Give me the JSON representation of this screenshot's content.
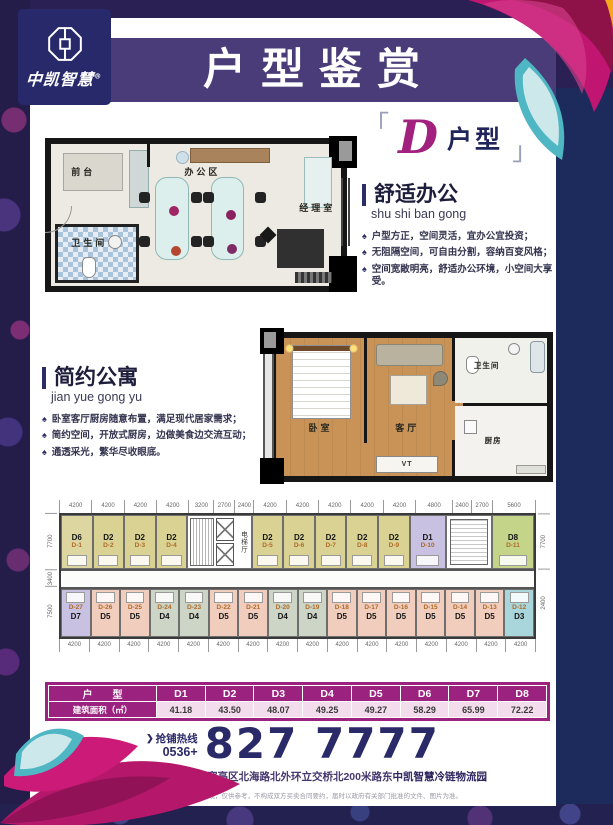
{
  "brand": {
    "logo_text": "中凯智慧",
    "logo_reg": "®",
    "emblem": "octagon-coin-emblem"
  },
  "header": {
    "banner_title": "户型鉴赏"
  },
  "unit_badge": {
    "open": "「",
    "letter": "D",
    "suffix": "户型",
    "close": "」"
  },
  "icons": {
    "bullet": "♠",
    "hotline_arrow": "❯"
  },
  "office_plan": {
    "rooms": {
      "reception": "前台",
      "work_area": "办公区",
      "manager": "经理室",
      "bathroom": "卫生间"
    }
  },
  "office_section": {
    "title": "舒适办公",
    "pinyin": "shu shi ban gong",
    "bullets": [
      "户型方正，空间灵活，宜办公宜投资；",
      "无阻隔空间，可自由分割，容纳百变风格；",
      "空间宽敞明亮，舒适办公环境，小空间大享受。"
    ]
  },
  "apartment_plan": {
    "rooms": {
      "bedroom": "卧室",
      "living": "客厅",
      "bathroom": "卫生间",
      "kitchen": "厨房"
    },
    "tv_label": "VT"
  },
  "apartment_section": {
    "title": "简约公寓",
    "pinyin": "jian yue gong yu",
    "bullets": [
      "卧室客厅厨房随意布置，满足现代居家需求；",
      "简约空间，开放式厨房，边做美食边交流互动；",
      "通透采光，繁华尽收眼底。"
    ]
  },
  "floorplate": {
    "elevator_hall": "电梯厅",
    "top_dims": [
      {
        "v": "4200",
        "f": "4200"
      },
      {
        "v": "4200",
        "f": "4200"
      },
      {
        "v": "4200",
        "f": "4200"
      },
      {
        "v": "4200",
        "f": "4200"
      },
      {
        "v": "3200",
        "f": "3200"
      },
      {
        "v": "2700",
        "f": "2700"
      },
      {
        "v": "2400",
        "f": "2400"
      },
      {
        "v": "4200",
        "f": "4200"
      },
      {
        "v": "4200",
        "f": "4200"
      },
      {
        "v": "4200",
        "f": "4200"
      },
      {
        "v": "4200",
        "f": "4200"
      },
      {
        "v": "4200",
        "f": "4200"
      },
      {
        "v": "4800",
        "f": "4800"
      },
      {
        "v": "2400",
        "f": "2400"
      },
      {
        "v": "2700",
        "f": "2700"
      },
      {
        "v": "5600",
        "f": "5600"
      }
    ],
    "bottom_dims": [
      {
        "v": "4200",
        "f": "1"
      },
      {
        "v": "4200",
        "f": "1"
      },
      {
        "v": "4200",
        "f": "1"
      },
      {
        "v": "4200",
        "f": "1"
      },
      {
        "v": "4200",
        "f": "1"
      },
      {
        "v": "4200",
        "f": "1"
      },
      {
        "v": "4200",
        "f": "1"
      },
      {
        "v": "4200",
        "f": "1"
      },
      {
        "v": "4200",
        "f": "1"
      },
      {
        "v": "4200",
        "f": "1"
      },
      {
        "v": "4200",
        "f": "1"
      },
      {
        "v": "4200",
        "f": "1"
      },
      {
        "v": "4200",
        "f": "1"
      },
      {
        "v": "4200",
        "f": "1"
      },
      {
        "v": "4200",
        "f": "1"
      },
      {
        "v": "4200",
        "f": "1"
      }
    ],
    "left_dims": [
      {
        "v": "7700",
        "f": "54"
      },
      {
        "v": "3400",
        "f": "16"
      },
      {
        "v": "7500",
        "f": "48"
      }
    ],
    "right_dims": [
      {
        "v": "7700",
        "f": "54"
      },
      {
        "v": "2400",
        "f": "64"
      }
    ],
    "top_row_a": [
      {
        "t": "D6",
        "n": "D-1",
        "bg": "#ddd6a0",
        "f": "4200"
      },
      {
        "t": "D2",
        "n": "D-2",
        "bg": "#d9d293",
        "f": "4200"
      },
      {
        "t": "D2",
        "n": "D-3",
        "bg": "#d9d293",
        "f": "4200"
      },
      {
        "t": "D2",
        "n": "D-4",
        "bg": "#d9d293",
        "f": "4200"
      }
    ],
    "top_row_b": [
      {
        "t": "D2",
        "n": "D-5",
        "bg": "#d9d293",
        "f": "4200"
      },
      {
        "t": "D2",
        "n": "D-6",
        "bg": "#d9d293",
        "f": "4200"
      },
      {
        "t": "D2",
        "n": "D-7",
        "bg": "#d9d293",
        "f": "4200"
      },
      {
        "t": "D2",
        "n": "D-8",
        "bg": "#d9d293",
        "f": "4200"
      },
      {
        "t": "D2",
        "n": "D-9",
        "bg": "#d9d293",
        "f": "4200"
      },
      {
        "t": "D1",
        "n": "D-10",
        "bg": "#c9c1e2",
        "f": "4800"
      }
    ],
    "top_row_c": [
      {
        "t": "D8",
        "n": "D-11",
        "bg": "#c4d489",
        "f": "5600"
      }
    ],
    "bottom_row": [
      {
        "t": "D7",
        "n": "D-27",
        "bg": "#c9c1e2"
      },
      {
        "t": "D5",
        "n": "D-26",
        "bg": "#f1cdbd"
      },
      {
        "t": "D5",
        "n": "D-25",
        "bg": "#f1cdbd"
      },
      {
        "t": "D4",
        "n": "D-24",
        "bg": "#ccd5c6"
      },
      {
        "t": "D4",
        "n": "D-23",
        "bg": "#ccd5c6"
      },
      {
        "t": "D5",
        "n": "D-22",
        "bg": "#f1cdbd"
      },
      {
        "t": "D5",
        "n": "D-21",
        "bg": "#f1cdbd"
      },
      {
        "t": "D4",
        "n": "D-20",
        "bg": "#ccd5c6"
      },
      {
        "t": "D4",
        "n": "D-19",
        "bg": "#ccd5c6"
      },
      {
        "t": "D5",
        "n": "D-18",
        "bg": "#f1cdbd"
      },
      {
        "t": "D5",
        "n": "D-17",
        "bg": "#f1cdbd"
      },
      {
        "t": "D5",
        "n": "D-16",
        "bg": "#f1cdbd"
      },
      {
        "t": "D5",
        "n": "D-15",
        "bg": "#f1cdbd"
      },
      {
        "t": "D5",
        "n": "D-14",
        "bg": "#f1cdbd"
      },
      {
        "t": "D5",
        "n": "D-13",
        "bg": "#f1cdbd"
      },
      {
        "t": "D3",
        "n": "D-12",
        "bg": "#a9d6da"
      }
    ]
  },
  "table": {
    "corner": "户　　型",
    "header": [
      "D1",
      "D2",
      "D3",
      "D4",
      "D5",
      "D6",
      "D7",
      "D8"
    ],
    "row_label": "建筑面积（㎡）",
    "values": [
      "41.18",
      "43.50",
      "48.07",
      "49.25",
      "49.27",
      "58.29",
      "65.99",
      "72.22"
    ]
  },
  "hotline": {
    "label": "抢铺热线",
    "prefix": "0536+",
    "number": "827 7777"
  },
  "address": {
    "main": "项目地址/山东省潍坊市寒亭区北海路北外环立交桥北200米路东",
    "bold": "中凯智慧冷链物流园"
  },
  "disclaimer": "本资料图片及文字仅作示意表现，仅供参考，不构成双方买卖合同要约，届时以政府有关部门批准的文件、图片为准。",
  "colors": {
    "accent_magenta": "#9c2280",
    "banner_purple": "#4a3c78",
    "logo_navy": "#27296a",
    "band_navy": "#1d2a5c",
    "d_letter": "#a2217f"
  }
}
